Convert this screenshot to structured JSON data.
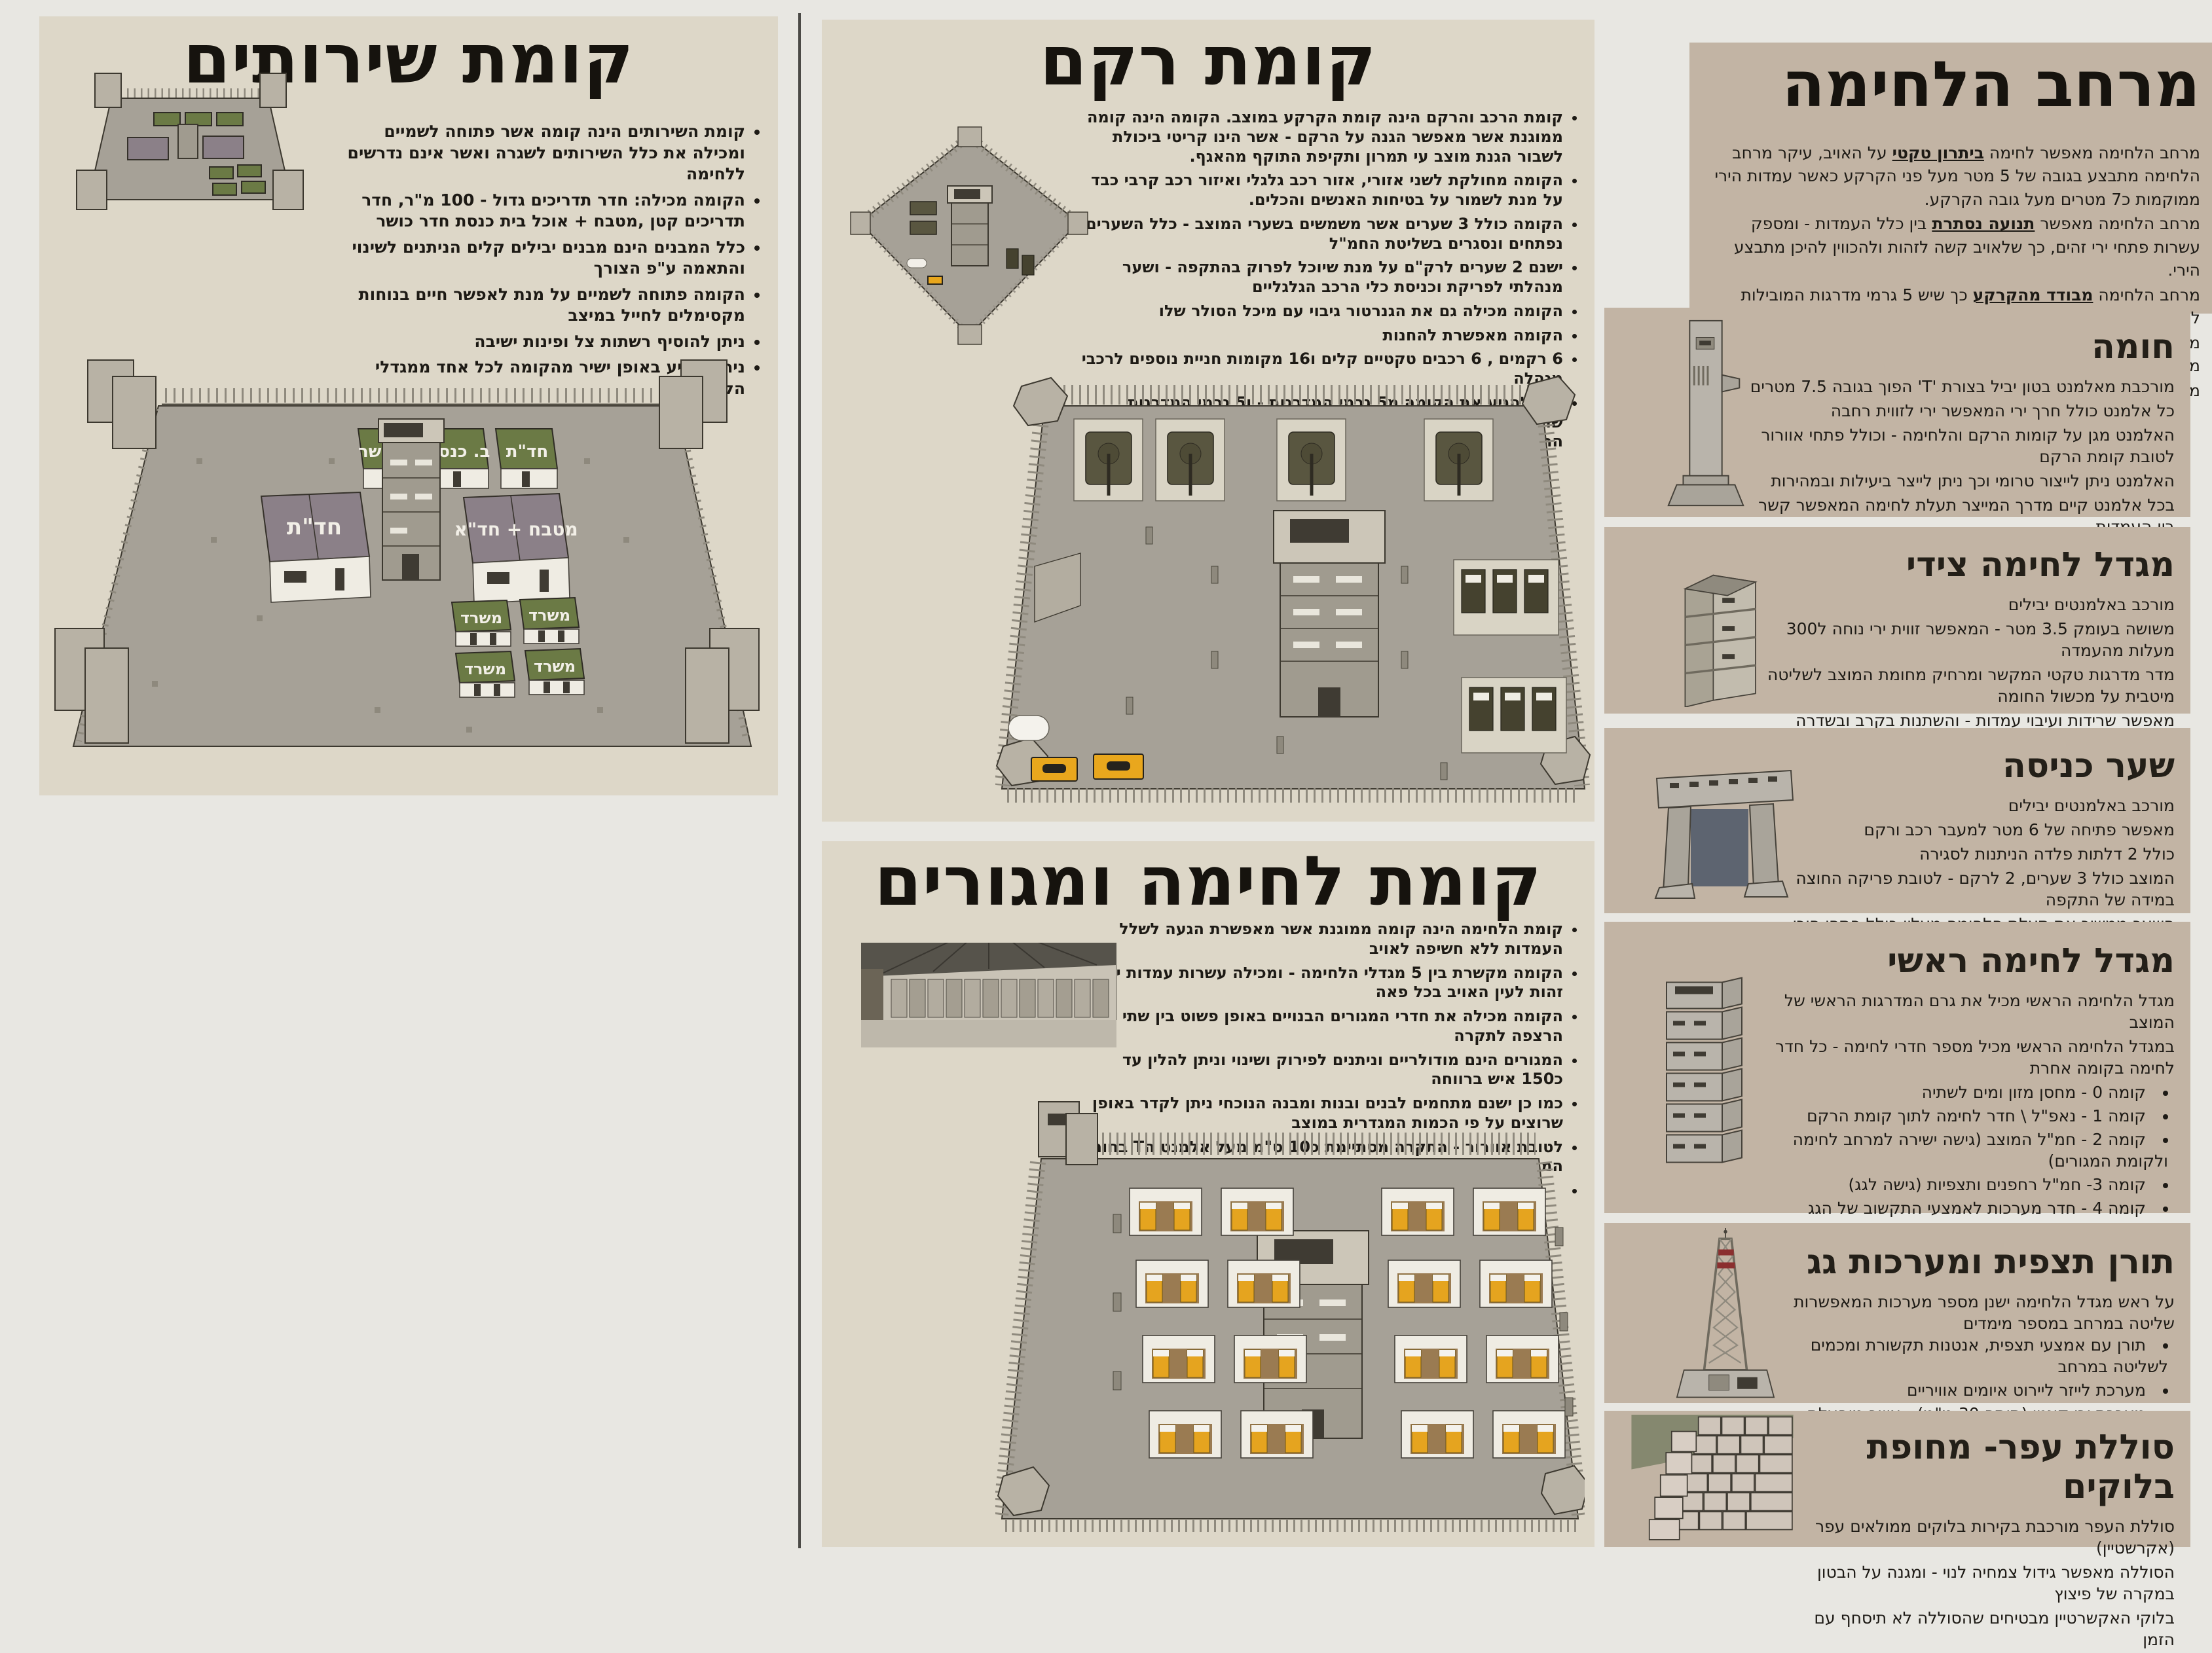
{
  "left_panel": {
    "title": "קומת שירותים",
    "bullets": [
      "קומת השירותים הינה קומה אשר פתוחה לשמיים ומכילה את כלל השירותים לשגרה ואשר אינם נדרשים ללחימה",
      "הקומה מכילה: חדר תדריכים גדול - 100 מ\"ר, חדר תדריכים קטן ,מטבח + אוכל בית כנסת חדר כושר",
      "כלל המבנים הינם מבנים יבילים קלים הניתנים לשינוי והתאמה ע\"פ הצורך",
      "הקומה פתוחה לשמיים על מנת לאפשר חיים בנוחות מקסימלים לחייל במיצב",
      "ניתן להוסיף רשתות צל ופינות ישיבה",
      "ניתן להגיע באופן ישיר מהקומה לכל אחד ממגדלי הלחימה"
    ],
    "plan_labels": {
      "gym": "ח. כושר",
      "synagogue": "ב. כנסת",
      "briefing_small": "חד\"ת",
      "briefing_large": "חד\"ת",
      "kitchen": "מטבח + חד\"א",
      "office": "משרד"
    }
  },
  "rkm_panel": {
    "title": "קומת רקם",
    "bullets": [
      "קומת הרכב והרקם הינה קומת הקרקע במוצב. הקומה הינה קומה ממוגנת אשר מאפשר הגנה על הרקם - אשר הינו קריטי ביכולת לשבור הגנת מוצב עי תמרון ותקיפת התוקף מהאגף.",
      "הקומה מחולקת לשני אזורי, אזור רכב גלגלי ואיזור רכב קרבי כבד על מנת לשמור על בטיחות האנשים והכלים.",
      "הקומה כולל 3 שערים אשר משמשים בשערי המוצב - כלל השערים נפתחים ונסגרים בשליטת החמ\"ל",
      "ישנם 2 שערים לרק\"ם על מנת שיוכל לפרוק בהתקפה - ושער מנהלתי לפריקת וכניסת כלי הרכב הגלגליים",
      "הקומה מכילה גם את הגנרטור גיבוי עם מיכל הסולר שלו",
      "הקומה מאפשרת להחנות",
      "6 רקמים , 6 רכבים טקטיים קלים ו16 מקומות חניית נוספים לרכבי מנהלה",
      "ניתן להגיע את הקומה מ5 גרמי המדרגות - ו5 גרמי המדרגות שולטים באש ותצפים על קומת הרקם במידה של חדירה לקומת הרקם"
    ]
  },
  "combat_panel": {
    "title": "קומת לחימה ומגורים",
    "bullets": [
      "קומת הלחימה הינה קומה ממוגנת אשר מאפשרת הגעה לשלל העמדות ללא חשיפה לאויב",
      "הקומה מקשרת בין 5 מגדלי הלחימה - ומכילה עשרות עמדות ירי זהות לעין האויב בכל פאה",
      "הקומה מכילה את חדרי המגורים הבנויים באופן פשוט בין שתי הרצפה לתקרה",
      "המגורים הינם מודולריים וניתנים לפירוק ושינוי וניתן להלין עד כ150 איש ברווחה",
      "כמו כן ישנם מתחמים לבנים ובנות ומבנה הנוכחי ניתן לקדר באופן שרוצים על פי הכמות המגדרית במוצב",
      "לטובת אוורור - התקרה מסתיימת כ10 ס\"מ מעל אלמנט הT בחומת המוצב מה שמאפשר כניסה ויציאת אוויר חופשי",
      ""
    ]
  },
  "right_column": {
    "title": "מרחב הלחימה",
    "intro": [
      [
        {
          "t": "מרחב  הלחימה מאפשר לחימה "
        },
        {
          "t": "ביתרון טקטי",
          "u": true
        },
        {
          "t": " על האויב, עיקר מרחב הלחימה מתבצע בגובה של 5 מטר מעל פני הקרקע כאשר עמדות הירי ממוקמות כ7 מטרים מעל גובה הקרקע."
        }
      ],
      [
        {
          "t": "מרחב הלחימה מאפשר "
        },
        {
          "t": "תנועה נסתרת",
          "u": true
        },
        {
          "t": " בין כלל העמדות - ומספק עשרות פתחי ירי זהים, כך שלאויב קשה לזהות ולהכווין להיכן מתבצע הירי."
        }
      ],
      [
        {
          "t": "מרחב הלחימה "
        },
        {
          "t": "מבודד מהקרקע",
          "u": true
        },
        {
          "t": " כך שיש 5 גרמי מדרגות המובילות למרחב הלחימה אשר ניתן לנעילה עי דלתות ברזל."
        }
      ],
      [
        {
          "t": "מרחב הלחימה מאפשר "
        },
        {
          "t": "הדדיות ועומק",
          "u": true
        },
        {
          "t": " בין העמדות אשר בחומה, ובין מגדלי הלחימה"
        }
      ],
      [
        {
          "t": "מרחב הלחימה מורכב מחומה, מגדלי לחימה צידיים ומגדל לחימה ראשי."
        }
      ]
    ],
    "sections": {
      "wall": {
        "title": "חומה",
        "lines": [
          "מורכבת מאלמנט בטון יביל בצורת 'T' הפוך בגובה 7.5 מטרים",
          "כל אלמנט כולל חרך ירי המאפשר ירי לזווית רחבה",
          "האלמנט מגן על קומות הרקם והלחימה - וכולל פתחי אוורור לטובת קומת הרקם",
          "האלמנט ניתן לייצור טרומי וכך ניתן לייצר ביעילות ובמהירות",
          "בכל אלמנט קיים מדרך המייצר תעלת לחימה המאפשר קשר בין העמדות",
          "המדרך מאפשר עמדת ירי במוצבים ארעיים  וכך לספק את היתרון הטקטי גם במגנן זמני"
        ]
      },
      "side_tower": {
        "title": "מגדל לחימה צידי",
        "lines": [
          "מורכב באלמנטים יבילים",
          "משושה בעומק 3.5 מטר - המאפשר זווית ירי נוחה ל300 מעלות מהעמדה",
          "מדר מדרגות טקטי המקשר ומרחיק מחומת המוצב לשליטה מיטבית על מכשול החומה",
          "מאפשר שרידות ועיבוי עמדות - והשתנות בקרב ובשדרה",
          "גרם המדרגות הטקטי ניתן לנעילה וכך מתאפשר בידוד מרחב הלחימה",
          "גגרם המדרגות הטקטי שולט באש גם על קומת הרקם במידה והיא נכבשת"
        ]
      },
      "gate": {
        "title": "שער כניסה",
        "lines": [
          "מורכב באלמנטים יבילים",
          "מאפשר פתיחה של 6 מטר למעבר רכב ורקם",
          "כולל 2 דלתות פלדה הניתנות לסגירה",
          "המוצב כולל 3 שערים, 2 לרקם - לטובת פריקה החוצה במידה של התקפה",
          "השער ממשיך את תעלת הלחימה מעליו כולל פתחי הירי ומשתלב על אלמנט החומה",
          "ניתן להוסיף שער נגרר - ולפתוח מהחמל אפשר 2 עמדות מחפות על השער"
        ]
      },
      "main_tower": {
        "title": "מגדל לחימה ראשי",
        "lead": [
          "מגדל הלחימה הראשי מכיל את גרם המדרגות הראשי של המוצב",
          "במגדל הלחימה הראשי מכיל מספר חדרי לחימה - כל חדר לחימה בקומה אחרת"
        ],
        "floors": [
          "קומה 0 - מחסן מזון ומים לשתיה",
          "קומה 1 - נאפ\"ל \\ חדר לחימה לתוך קומת הרקם",
          "קומה 2 - חמ\"ל המוצב (גישה ישירה למרחב לחימה ולקומת המגורים)",
          "קומה 3- חמ\"ל רחפנים ותצפיות (גישה לגג)",
          "קומה 4 - חדר מערכות לאמצעי התקשוב של הגג",
          "קומה 5 - קומת מלחמה 360 מעלות לטווח רחוק (צלפים + מקלענים)"
        ],
        "outro": [
          "רכיבי המגדל הינם יבילים (3.5X7 m)",
          "כלל הקומות מכילות חרכי ירי (ניתן לחוסמם) על מנת - על מנת לאפשר השתנות"
        ]
      },
      "mast": {
        "title": "תורן תצפית ומערכות גג",
        "lead": "על ראש מגדל הלחימה ישנן מספר מערכות המאפשרות שליטה במרחב במספר מימדים",
        "bullets": [
          "תורן עם אמצעי תצפית, אנטנות תקשורת ומכמים לשליטה במרחב",
          "מערכת לייזר ליירוט איומים אוויריים",
          "מערכת ירי קינטי (תותח 30 מ\"מ)  -  אשר מופעלת מעמדה מרוחקת"
        ]
      },
      "berm": {
        "title": "סוללת עפר- מחופת בלוקים",
        "lines": [
          "סוללת העפר מורכבת בקירות בלוקים ממולאים עפר (אקרשטיין)",
          "הסוללה מאפשר גידול צמחיה לנוי - ומגנה על הבטון במקרה של פיצוץ",
          "בלוקי האקשרטיין מבטיחים שהסוללה לא תיסחף עם הזמן"
        ]
      }
    }
  }
}
